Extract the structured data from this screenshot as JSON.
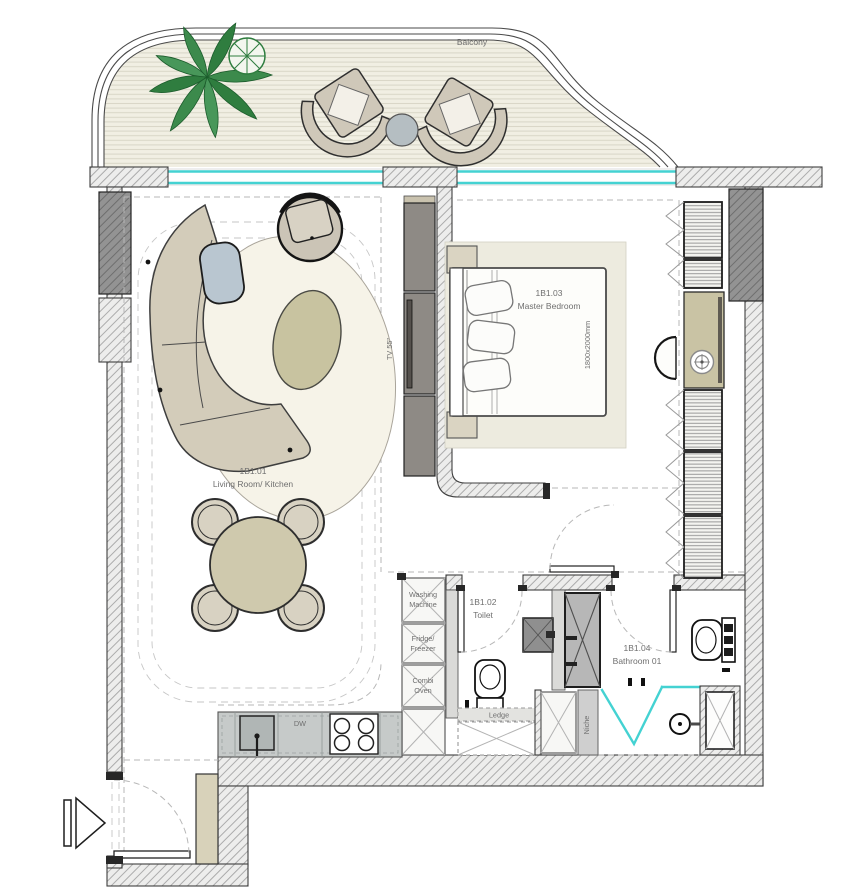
{
  "colors": {
    "glass_cyan": "#44d2d2",
    "label_gray": "#6f6f6f",
    "wall_outline": "#3f3f3f",
    "column_gray": "#8f8f8f",
    "deck_bg": "#f1efe3",
    "deck_line": "#d9d6c7",
    "furniture_beige": "#d3ccba",
    "cushion_cream": "#f3f0e8",
    "rug_cream": "#f6f3e8",
    "ottoman_olive": "#c8c3a0",
    "table_beige": "#cfc9ad",
    "bedroom_rug": "#edebdf",
    "side_table_blue": "#b9c6d0",
    "plant_green": "#3c8a4c",
    "tv_cabinet_dark": "#8e8a85",
    "counter_gray": "#c6cac9",
    "cabinet_tan": "#d8d2ba"
  },
  "balcony": {
    "label": "Balcony"
  },
  "living_room": {
    "code": "1B1.01",
    "name": "Living Room/ Kitchen",
    "tv_label": "TV 55\""
  },
  "master_bedroom": {
    "code": "1B1.03",
    "name": "Master Bedroom",
    "bed_dimension": "1800x2000mm"
  },
  "toilet": {
    "code": "1B1.02",
    "name": "Toilet",
    "ledge_label": "Ledge"
  },
  "bathroom": {
    "code": "1B1.04",
    "name": "Bathroom 01",
    "niche_label": "Niche"
  },
  "kitchen": {
    "dishwasher_label": "DW"
  },
  "appliances": {
    "washing_machine_lines": [
      "Washing",
      "Machine"
    ],
    "fridge_freezer_lines": [
      "Fridge/",
      "Freezer"
    ],
    "combi_oven_lines": [
      "Combi",
      "Oven"
    ]
  }
}
